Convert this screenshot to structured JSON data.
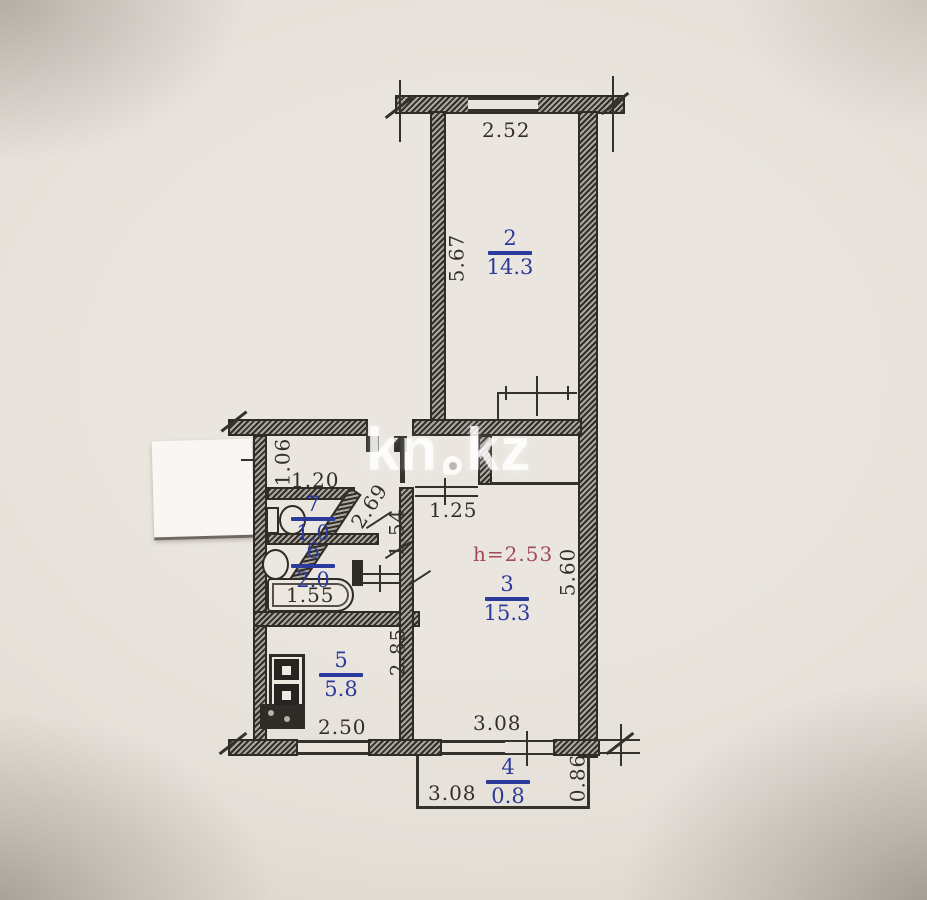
{
  "photo": {
    "watermark_part1": "kn",
    "watermark_part2": "kz"
  },
  "plan": {
    "height_note": "h=2.53",
    "accent_blue": "#2c3a9b",
    "accent_red": "#a04a58",
    "rooms": [
      {
        "number": "2",
        "area": "14.3"
      },
      {
        "number": "3",
        "area": "15.3"
      },
      {
        "number": "4",
        "area": "0.8"
      },
      {
        "number": "5",
        "area": "5.8"
      },
      {
        "number": "6",
        "area": "2.0"
      },
      {
        "number": "7",
        "area": "1.0"
      }
    ],
    "dimensions": {
      "room2_width": "2.52",
      "room2_depth": "5.67",
      "hall_depth": "1.06",
      "wc_width": "1.20",
      "slant_wall": "2.69",
      "corridor": "1.54",
      "hall_opening": "1.25",
      "bath_length": "1.55",
      "kitchen_depth": "2.85",
      "kitchen_width": "2.50",
      "room3_depth": "5.60",
      "room3_width": "3.08",
      "balcony_width": "3.08",
      "balcony_depth": "0.86"
    }
  }
}
